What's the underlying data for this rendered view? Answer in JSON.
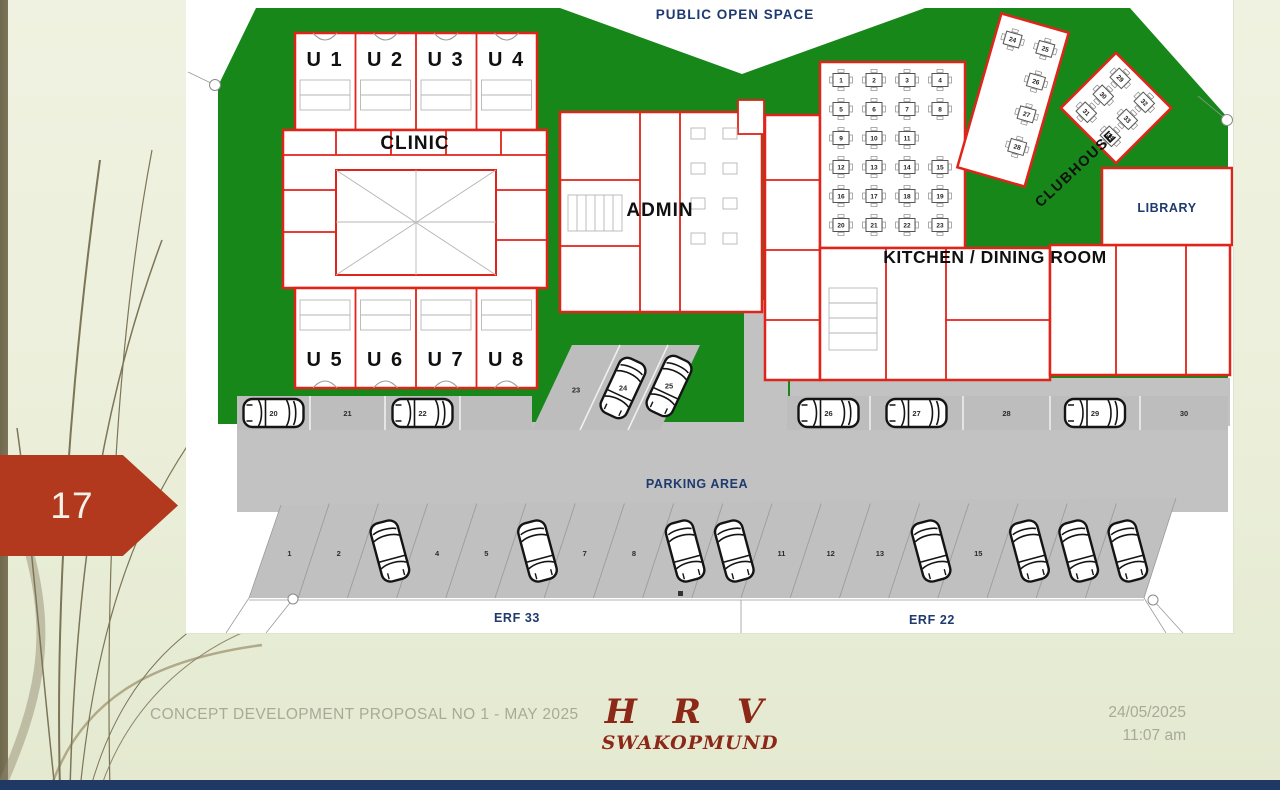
{
  "slide": {
    "page_number": "17",
    "footer": {
      "left_text": "CONCEPT DEVELOPMENT PROPOSAL NO 1 - MAY 2025",
      "brand_title": "H R V",
      "brand_subtitle": "SWAKOPMUND",
      "date": "24/05/2025",
      "time": "11:07 am"
    }
  },
  "plan": {
    "labels": {
      "public_open_space": "PUBLIC OPEN SPACE",
      "clinic": "CLINIC",
      "admin": "ADMIN",
      "clubhouse": "CLUBHOUSE",
      "library": "LIBRARY",
      "kitchen_dining": "KITCHEN / DINING ROOM",
      "parking_area": "PARKING AREA",
      "erf_left": "ERF 33",
      "erf_right": "ERF 22"
    },
    "units_top": [
      "U 1",
      "U 2",
      "U 3",
      "U 4"
    ],
    "units_bottom": [
      "U 5",
      "U 6",
      "U 7",
      "U 8"
    ],
    "dining_tables": [
      [
        "1",
        "2",
        "3",
        "4"
      ],
      [
        "5",
        "6",
        "7",
        "8"
      ],
      [
        "9",
        "10",
        "11",
        ""
      ],
      [
        "12",
        "13",
        "14",
        "15"
      ],
      [
        "16",
        "17",
        "18",
        "19"
      ],
      [
        "20",
        "21",
        "22",
        "23"
      ]
    ],
    "corridor_tables": [
      "24",
      "25",
      "26",
      "27",
      "28"
    ],
    "clubhouse_tables": [
      "29",
      "30",
      "31",
      "32",
      "33",
      "34"
    ],
    "parking": {
      "upper_left": [
        {
          "label": "20",
          "car": true
        },
        {
          "label": "21",
          "car": false
        },
        {
          "label": "22",
          "car": true
        },
        {
          "label": "",
          "car": false
        }
      ],
      "middle_diagonal": [
        {
          "label": "23",
          "car": false
        },
        {
          "label": "24",
          "car": true
        },
        {
          "label": "25",
          "car": true
        }
      ],
      "upper_right": [
        {
          "label": "26",
          "car": true
        },
        {
          "label": "27",
          "car": true
        },
        {
          "label": "28",
          "car": false
        },
        {
          "label": "29",
          "car": true
        },
        {
          "label": "30",
          "car": false
        }
      ],
      "lower": [
        {
          "label": "1",
          "car": false
        },
        {
          "label": "2",
          "car": false
        },
        {
          "label": "3",
          "car": true
        },
        {
          "label": "4",
          "car": false
        },
        {
          "label": "5",
          "car": false
        },
        {
          "label": "6",
          "car": true
        },
        {
          "label": "7",
          "car": false
        },
        {
          "label": "8",
          "car": false
        },
        {
          "label": "9",
          "car": true
        },
        {
          "label": "10",
          "car": true
        },
        {
          "label": "11",
          "car": false
        },
        {
          "label": "12",
          "car": false
        },
        {
          "label": "13",
          "car": false
        },
        {
          "label": "14",
          "car": true
        },
        {
          "label": "15",
          "car": false
        },
        {
          "label": "16",
          "car": true
        },
        {
          "label": "17",
          "car": true
        },
        {
          "label": "18",
          "car": true
        }
      ]
    }
  },
  "colors": {
    "site_green": "#17871a",
    "wall_red": "#e0241a",
    "navy_text": "#1e3a6e",
    "parking_gray": "#bdbdbd",
    "road_gray": "#c2c2c2",
    "arrow_red": "#b2391e",
    "brand_maroon": "#8c2818",
    "footer_gray": "#a7aa99",
    "bottom_bar_navy": "#1f3864"
  }
}
